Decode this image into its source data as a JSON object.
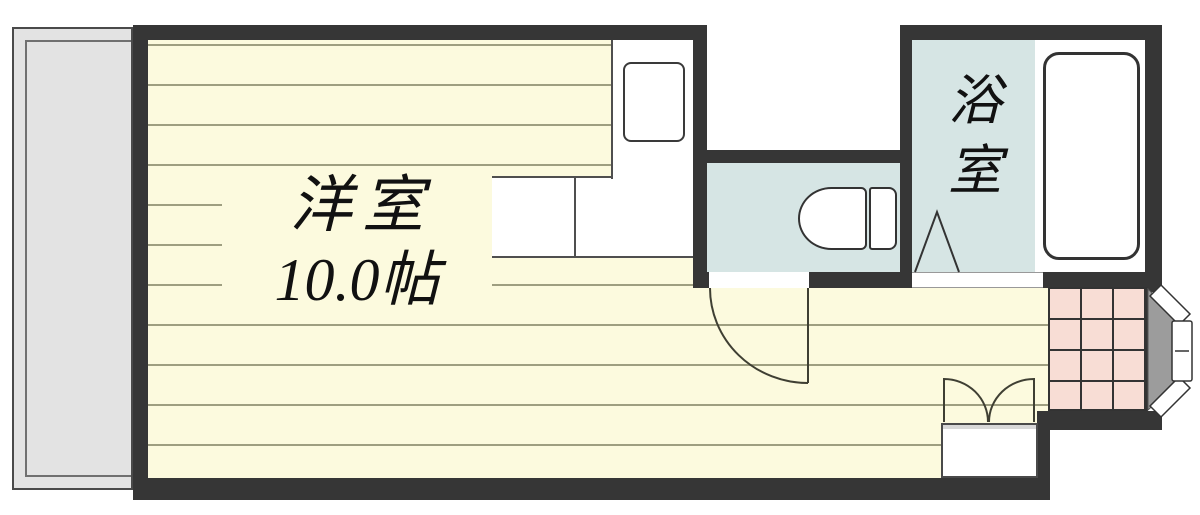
{
  "floor_plan": {
    "main_room": {
      "name": "洋室",
      "size": "10.0帖"
    },
    "bathroom": {
      "name": "浴室",
      "name_chars": [
        "浴",
        "室"
      ]
    },
    "colors": {
      "wall": "#363636",
      "floor": "#fcfade",
      "floor_line": "#9e9e80",
      "wet_area_blue": "#d6e5e4",
      "entrance_tile_pink": "#f8ddd5",
      "balcony_gray": "#e3e3e3",
      "entrance_door_gray": "#9c9c9c",
      "fixture_white": "#ffffff"
    },
    "fixtures": [
      "balcony",
      "kitchen-counter",
      "stove",
      "toilet",
      "bathtub",
      "folding-bath-door",
      "hinged-toilet-door",
      "double-closet-door",
      "shoe-cabinet",
      "entrance-door",
      "entrance-tiles"
    ]
  }
}
